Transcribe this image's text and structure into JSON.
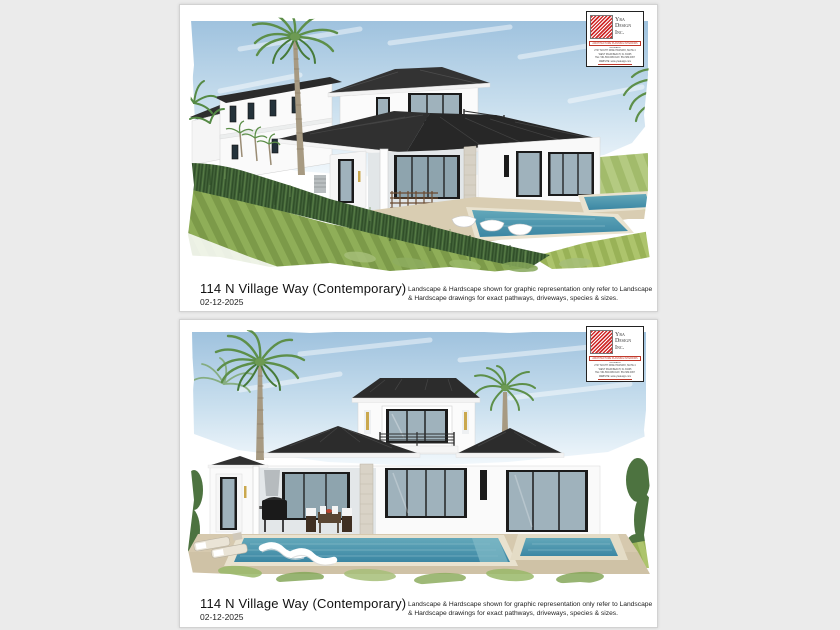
{
  "page": {
    "background_color": "#ebebeb",
    "sheet_color": "#ffffff"
  },
  "sheets": [
    {
      "id": "front-perspective",
      "title": "114 N Village Way (Contemporary)",
      "date": "02-12-2025",
      "disclaimer_line1": "Landscape & Hardscape shown for graphic representation only refer to Landscape",
      "disclaimer_line2": "& Hardscape drawings for exact pathways, driveways, species & sizes."
    },
    {
      "id": "rear-elevation",
      "title": "114 N Village Way (Contemporary)",
      "date": "02-12-2025",
      "disclaimer_line1": "Landscape & Hardscape shown for graphic representation only refer to Landscape",
      "disclaimer_line2": "& Hardscape drawings for exact pathways, driveways, species & sizes."
    }
  ],
  "logo": {
    "company_line1": "Yra",
    "company_line2": "Design",
    "company_line3": "Inc.",
    "tagline": "ARCHITECTURE  PLANNING  INTERIORS",
    "fine_print": [
      "ALAMEDA",
      "2747 SOUTH DIXIE HIGHWAY, SUITE 4",
      "WEST PALM BEACH, FL 33405",
      "TEL: 561.582.0066  FAX: 561.582.0067",
      "WEBSITE: www.yradesign.com"
    ],
    "accent_color": "#c0392b"
  },
  "colors": {
    "sky": "#a3c4df",
    "roof": "#2b2b2b",
    "wall": "#fbfbfb",
    "glass": "#9fb2bc",
    "pool_water": "#4d98ad",
    "deck": "#d9cdb2",
    "hedge": "#44663a",
    "lawn_light": "#8fae58",
    "lawn_dark": "#7c9a49",
    "palm_frond": "#5d8f49",
    "palm_trunk": "#a79a82"
  }
}
